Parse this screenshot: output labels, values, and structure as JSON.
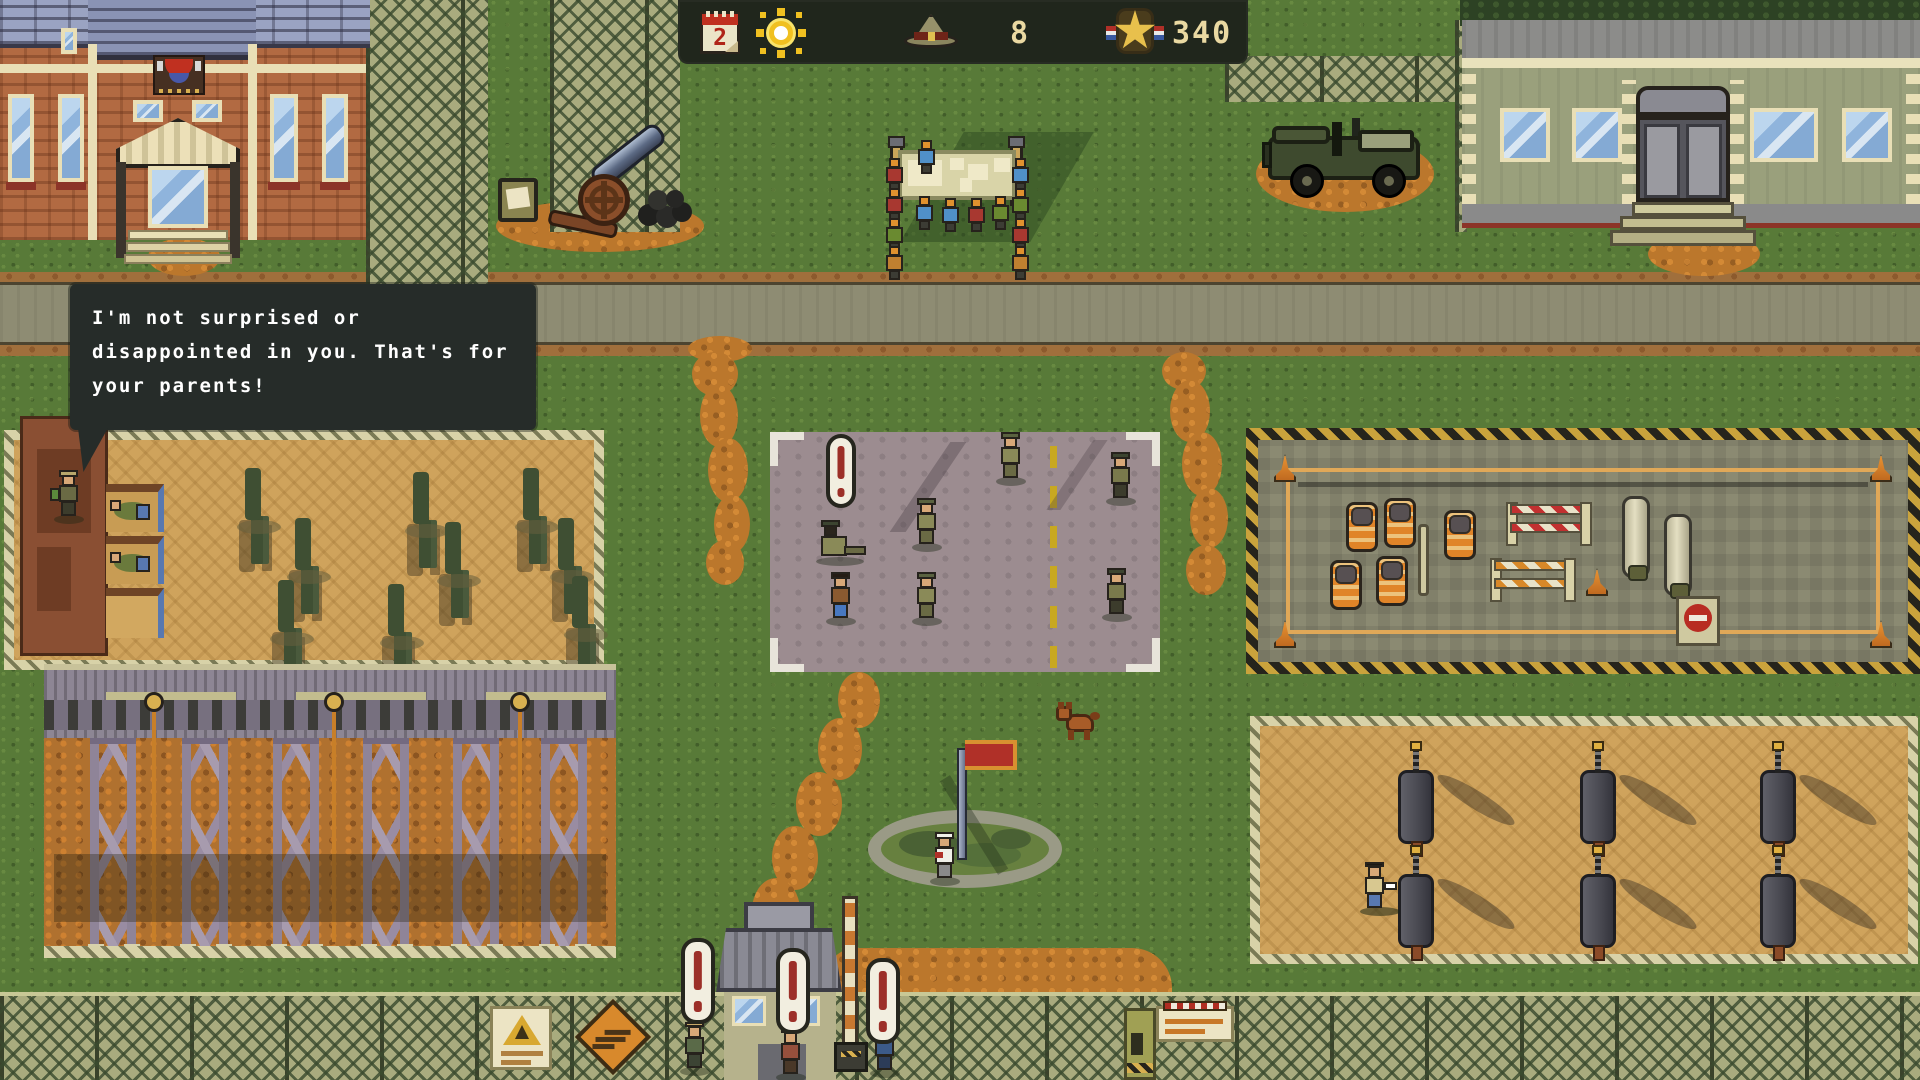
{
  "hud": {
    "day": "2",
    "recruits": "8",
    "score": "340",
    "icons": [
      "calendar-icon",
      "sun-icon",
      "recruit-hat-icon",
      "star-medal-icon"
    ]
  },
  "speech": {
    "speaker": "drill-sergeant",
    "lines": [
      "I'm not surprised or",
      "disappointed in you. That's for",
      "your parents!"
    ]
  },
  "alerts": {
    "symbol": "!"
  },
  "colors": {
    "grass": "#587a38",
    "road": "#8e8c73",
    "dirt": "#bb772c",
    "sand": "#cfa35c",
    "muster_pad": "#9c8c90",
    "hud_bg": "#20261c",
    "hud_text": "#ead9a2",
    "alert_red": "#9c2f28",
    "bubble_bg": "#262c29",
    "bubble_text": "#ffffff",
    "flag_red": "#b03028",
    "barrel_orange": "#e08428"
  }
}
